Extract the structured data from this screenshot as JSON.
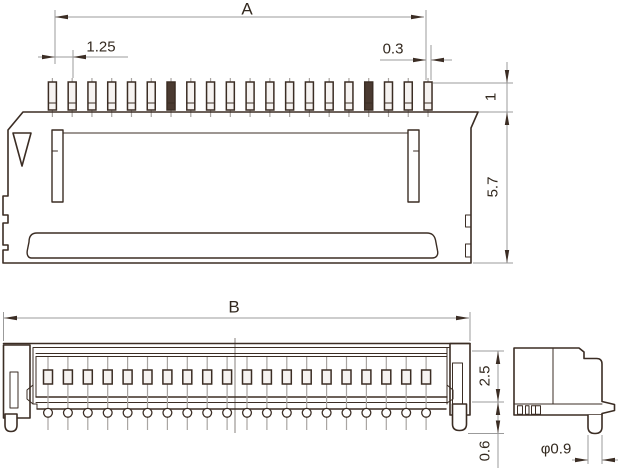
{
  "labels": {
    "top_view": {
      "overall_width": "A",
      "pin_pitch": "1.25",
      "pin_width": "0.3",
      "pin_exposed_height": "1",
      "body_depth": "5.7"
    },
    "front_view": {
      "overall_width": "B",
      "body_height": "2.5",
      "standoff_height": "0.6"
    },
    "side_view": {
      "pin_diameter": "φ0.9"
    }
  },
  "pins": {
    "top": {
      "count": 20,
      "dark_indices": [
        6,
        16
      ]
    },
    "front": {
      "count": 20
    }
  },
  "colors": {
    "line": "#3b2d24",
    "dim_line": "#9b9b9b",
    "centerline": "#a9a5a2",
    "text": "#33291f",
    "background": "#ffffff"
  }
}
